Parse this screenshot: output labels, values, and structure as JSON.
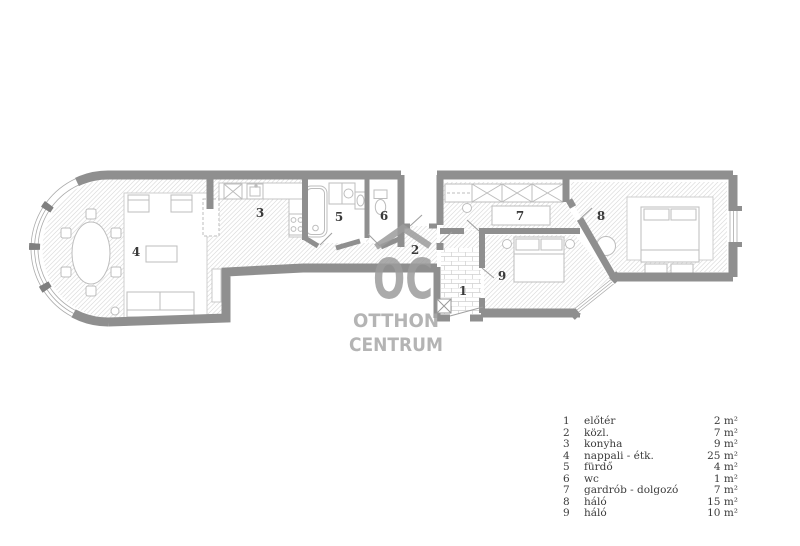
{
  "plan": {
    "labels": {
      "room1": "1",
      "room2": "2",
      "room3": "3",
      "room4": "4",
      "room5": "5",
      "room6": "6",
      "room7": "7",
      "room8": "8",
      "room9": "9"
    }
  },
  "watermark": {
    "monogram": "OC",
    "word1": "OTTHON",
    "word2": "CENTRUM"
  },
  "legend": {
    "rows": [
      {
        "num": "1",
        "name": "előtér",
        "area": "2 m²"
      },
      {
        "num": "2",
        "name": "közl.",
        "area": "7 m²"
      },
      {
        "num": "3",
        "name": "konyha",
        "area": "9 m²"
      },
      {
        "num": "4",
        "name": "nappali - étk.",
        "area": "25 m²"
      },
      {
        "num": "5",
        "name": "fürdő",
        "area": "4 m²"
      },
      {
        "num": "6",
        "name": "wc",
        "area": "1 m²"
      },
      {
        "num": "7",
        "name": "gardrób - dolgozó",
        "area": "7 m²"
      },
      {
        "num": "8",
        "name": "háló",
        "area": "15 m²"
      },
      {
        "num": "9",
        "name": "háló",
        "area": "10 m²"
      }
    ]
  },
  "colors": {
    "wall": "#8f8f8f",
    "floor_hatch_line": "#dcdcdc",
    "furniture_stroke": "#bdbdbd",
    "label_text": "#3a3a3a",
    "watermark_gray": "#9c9c9c"
  }
}
